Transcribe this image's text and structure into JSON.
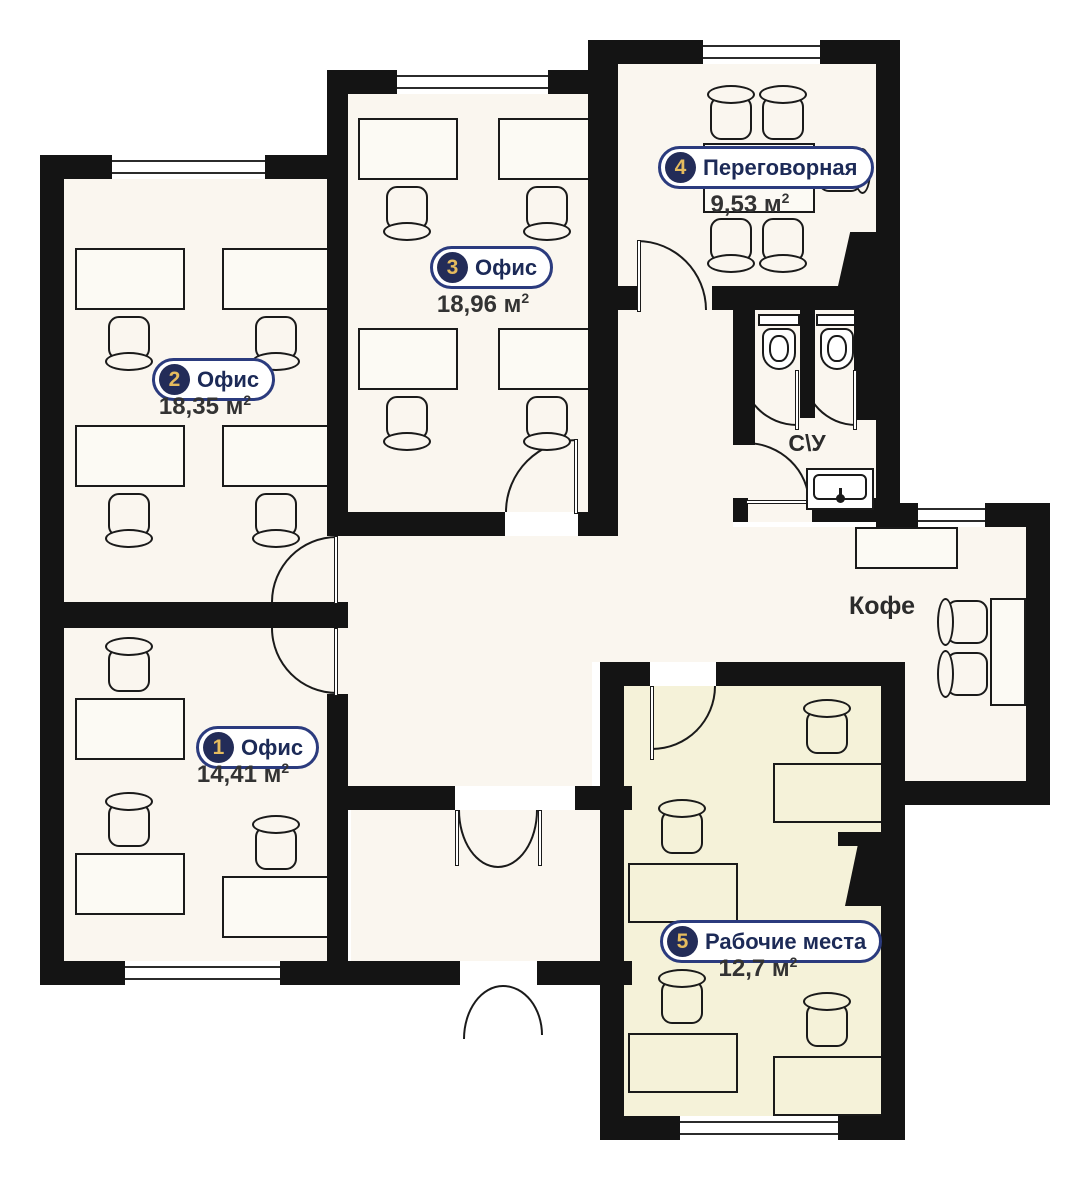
{
  "plan": {
    "title": "Офисный этаж — план помещений",
    "rooms": [
      {
        "number": "1",
        "name": "Офис",
        "area": "14,41 м",
        "sup": "2"
      },
      {
        "number": "2",
        "name": "Офис",
        "area": "18,35 м",
        "sup": "2"
      },
      {
        "number": "3",
        "name": "Офис",
        "area": "18,96 м",
        "sup": "2"
      },
      {
        "number": "4",
        "name": "Переговорная",
        "area": "9,53 м",
        "sup": "2"
      },
      {
        "number": "5",
        "name": "Рабочие места",
        "area": "12,7 м",
        "sup": "2"
      }
    ],
    "zones": [
      {
        "id": "wc",
        "label": "С\\У"
      },
      {
        "id": "coffee",
        "label": "Кофе"
      }
    ],
    "colors": {
      "wall": "#141414",
      "floor": "#faf6ef",
      "floor_highlight": "#f5f2d9",
      "badge_bg": "#232c58",
      "badge_number": "#e5bb5e",
      "label_text": "#1c2a57",
      "label_border": "#2b3b7e",
      "area_text": "#333333"
    }
  }
}
